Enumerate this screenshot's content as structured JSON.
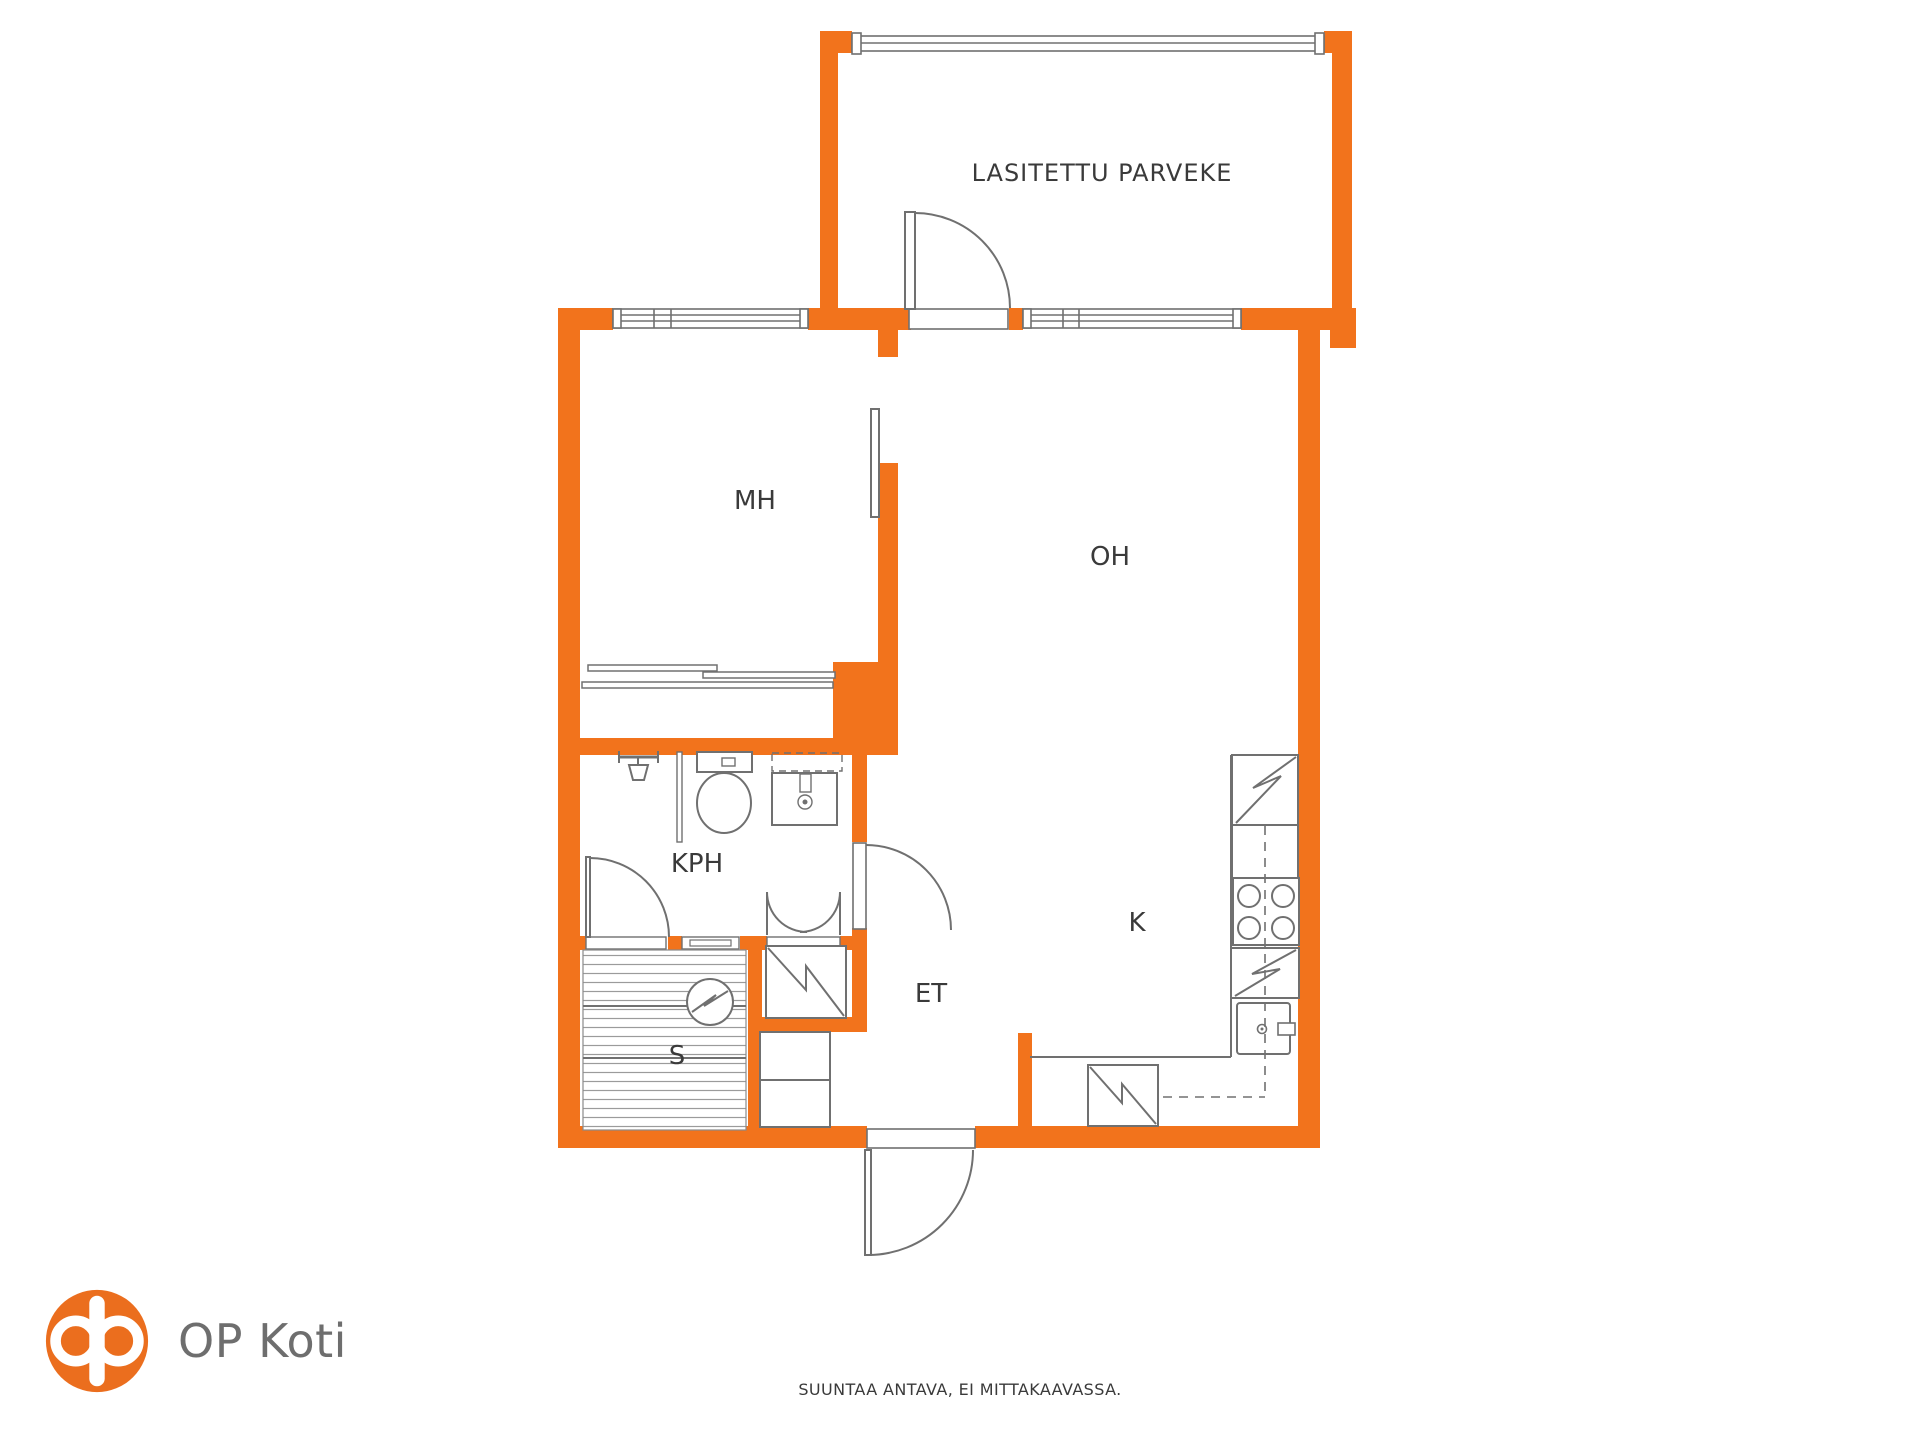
{
  "plan": {
    "title_room": "LASITETTU PARVEKE",
    "rooms": {
      "parveke": {
        "label": "LASITETTU PARVEKE"
      },
      "mh": {
        "label": "MH"
      },
      "oh": {
        "label": "OH"
      },
      "kph": {
        "label": "KPH"
      },
      "et": {
        "label": "ET"
      },
      "k": {
        "label": "K"
      },
      "s": {
        "label": "S"
      }
    },
    "colors": {
      "wall_orange": "#F2731C",
      "line_gray": "#707070",
      "label_text": "#3A3A3A"
    },
    "icons": [
      "shower-icon",
      "toilet-icon",
      "washbasin-icon",
      "sauna-stove-icon",
      "water-heater-icon",
      "wardrobe-icon",
      "cabinet-icon",
      "refrigerator-icon",
      "cooktop-icon",
      "dishwasher-icon",
      "kitchen-sink-icon"
    ]
  },
  "branding": {
    "logo_text": "OP Koti",
    "logo_orange": "#EB6E1E",
    "logo_text_color": "#6E6E6E"
  },
  "footer": {
    "disclaimer": "SUUNTAA ANTAVA, EI MITTAKAAVASSA."
  }
}
